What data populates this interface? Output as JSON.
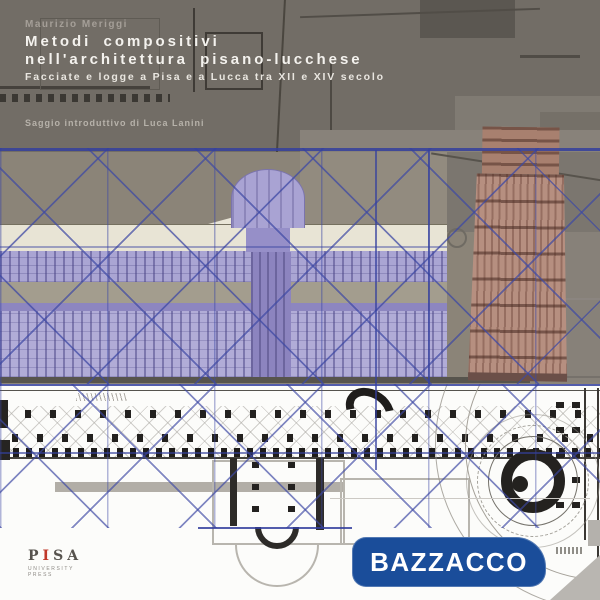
{
  "book_cover": {
    "author": "Maurizio Meriggi",
    "title_line1": "Metodi compositivi",
    "title_line2": "nell'architettura pisano-lucchese",
    "subtitle": "Facciate e logge a Pisa e a Lucca tra XII e XIV secolo",
    "intro_credit": "Saggio introduttivo di Luca Lanini"
  },
  "publisher_logo": {
    "letters": [
      "P",
      "I",
      "S",
      "A"
    ],
    "tagline": "UNIVERSITY PRESS"
  },
  "seller_badge": {
    "label": "BAZZACCO"
  },
  "colors": {
    "badge_blue": "#1a4d9a",
    "analysis_line_blue": "#4150a8",
    "cathedral_lavender": "#a9a3d3",
    "tower_terracotta": "#b68f80",
    "header_gray": "#726d66",
    "plan_paper_white": "#fcfcfa",
    "publisher_red": "#c0392b",
    "title_text": "#f4f2ee"
  }
}
